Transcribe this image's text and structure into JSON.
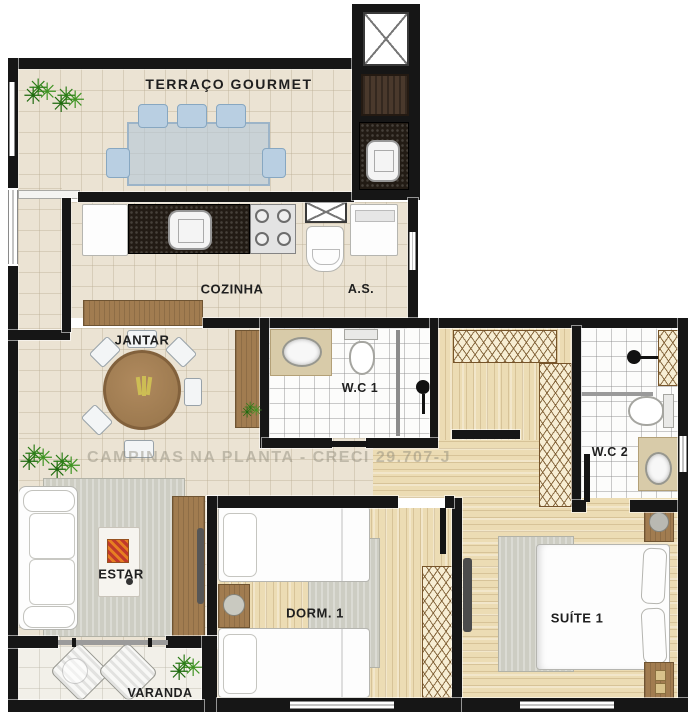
{
  "plan": {
    "watermark": "CAMPINAS NA PLANTA - CRECI 29.707-J",
    "rooms": {
      "terraco_gourmet": {
        "label": "TERRAÇO GOURMET"
      },
      "cozinha": {
        "label": "COZINHA"
      },
      "area_servico": {
        "label": "A.S."
      },
      "jantar": {
        "label": "JANTAR"
      },
      "wc1": {
        "label": "W.C 1"
      },
      "wc2": {
        "label": "W.C 2"
      },
      "estar": {
        "label": "ESTAR"
      },
      "dorm1": {
        "label": "DORM. 1"
      },
      "suite1": {
        "label": "SUÍTE 1"
      },
      "varanda": {
        "label": "VARANDA"
      }
    },
    "symbols": {
      "terraco_gourmet": [
        "dining-table",
        "blue-chairs",
        "grill",
        "granite-counter-sink",
        "service-shaft",
        "plants"
      ],
      "cozinha": [
        "fridge",
        "granite-counter",
        "kitchen-sink",
        "cooktop-4-burners"
      ],
      "area_servico": [
        "laundry-tank",
        "washing-machine"
      ],
      "jantar": [
        "round-wood-table",
        "white-chairs",
        "bar-counter",
        "side-cabinet",
        "plants"
      ],
      "wc1": [
        "washbasin-counter",
        "toilet",
        "shower"
      ],
      "wc2": [
        "shower",
        "duct",
        "toilet",
        "washbasin-counter"
      ],
      "estar": [
        "sofa",
        "coffee-table",
        "tv-rack",
        "tv",
        "rug",
        "plants"
      ],
      "dorm1": [
        "single-bed",
        "single-bed",
        "nightstand-lamp",
        "rug",
        "wardrobe"
      ],
      "suite1": [
        "double-bed",
        "pillows",
        "nightstands",
        "rug",
        "wardrobe",
        "tv"
      ],
      "varanda": [
        "lounge-chair",
        "lounge-chair",
        "side-table",
        "plant"
      ]
    },
    "colors": {
      "wall": "#161616",
      "tile_floor": "#ebe3d3",
      "wood_floor": "#ecdcb4",
      "wc_floor": "#fcfcfb",
      "granite": "#221b14",
      "wood_furniture": "#a17c50",
      "rug": "#cdcdc3",
      "chair_blue": "#b9cfe2",
      "plant_green": "#2c7d17",
      "watermark_gray": "#8a8476"
    }
  }
}
